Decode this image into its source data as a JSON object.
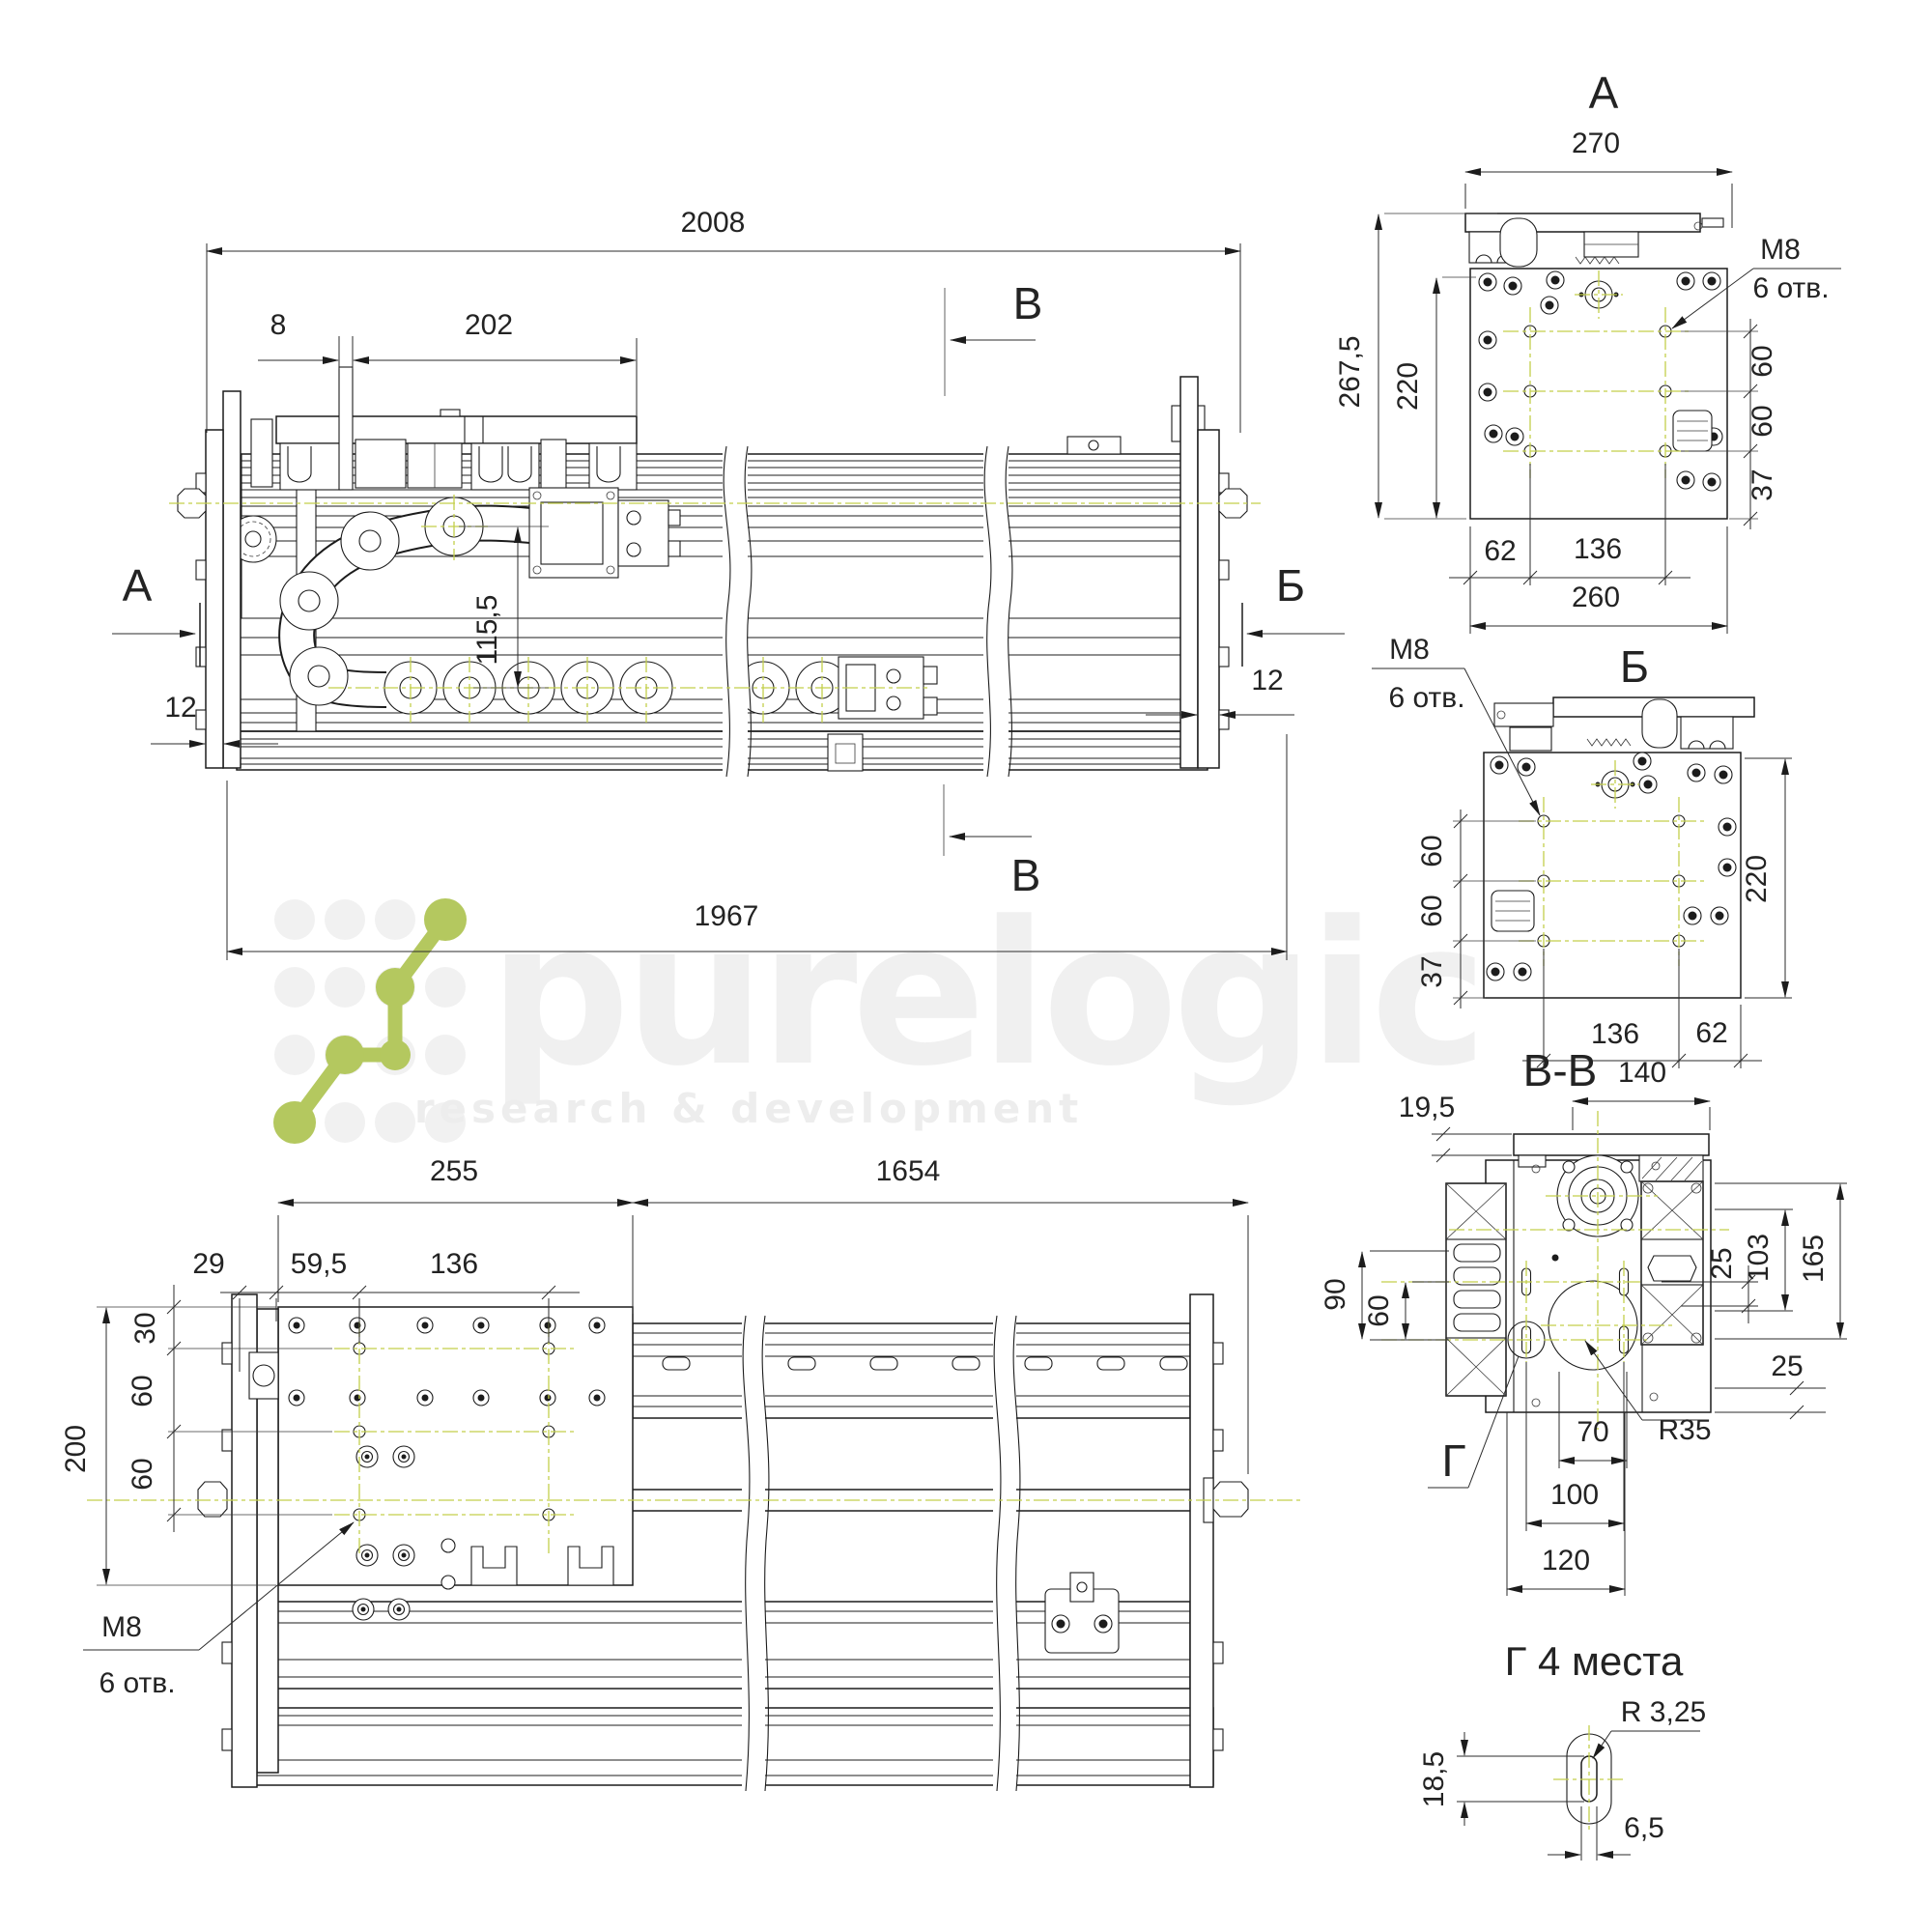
{
  "watermark": {
    "brand": "purelogic",
    "tagline": "research & development"
  },
  "front": {
    "dim_2008": "2008",
    "dim_8": "8",
    "dim_202": "202",
    "dim_115": "115,5",
    "dim_12l": "12",
    "dim_12r": "12",
    "dim_1967": "1967",
    "marker_a": "А",
    "marker_b": "Б",
    "marker_v_top": "В",
    "marker_v_bottom": "В"
  },
  "view_a": {
    "title": "А",
    "d270": "270",
    "d267": "267,5",
    "d220": "220",
    "m8": "М8",
    "holes": "6 отв.",
    "d60a": "60",
    "d60b": "60",
    "d37": "37",
    "d62": "62",
    "d136": "136",
    "d260": "260"
  },
  "view_b": {
    "title": "Б",
    "m8": "М8",
    "holes": "6 отв.",
    "d60a": "60",
    "d60b": "60",
    "d37": "37",
    "d220": "220",
    "d136": "136",
    "d62": "62"
  },
  "section": {
    "title": "В-В",
    "d19": "19,5",
    "d140": "140",
    "d25a": "25",
    "d103": "103",
    "d165": "165",
    "d90": "90",
    "d60": "60",
    "d25b": "25",
    "r35": "R35",
    "g": "Г",
    "d70": "70",
    "d100": "100",
    "d120": "120"
  },
  "top": {
    "d255": "255",
    "d1654": "1654",
    "d29": "29",
    "d59": "59,5",
    "d136": "136",
    "d30": "30",
    "d60a": "60",
    "d60b": "60",
    "d200": "200",
    "m8": "М8",
    "holes": "6 отв."
  },
  "detail": {
    "title": "Г 4 места",
    "r": "R 3,25",
    "d18": "18,5",
    "d6": "6,5"
  }
}
